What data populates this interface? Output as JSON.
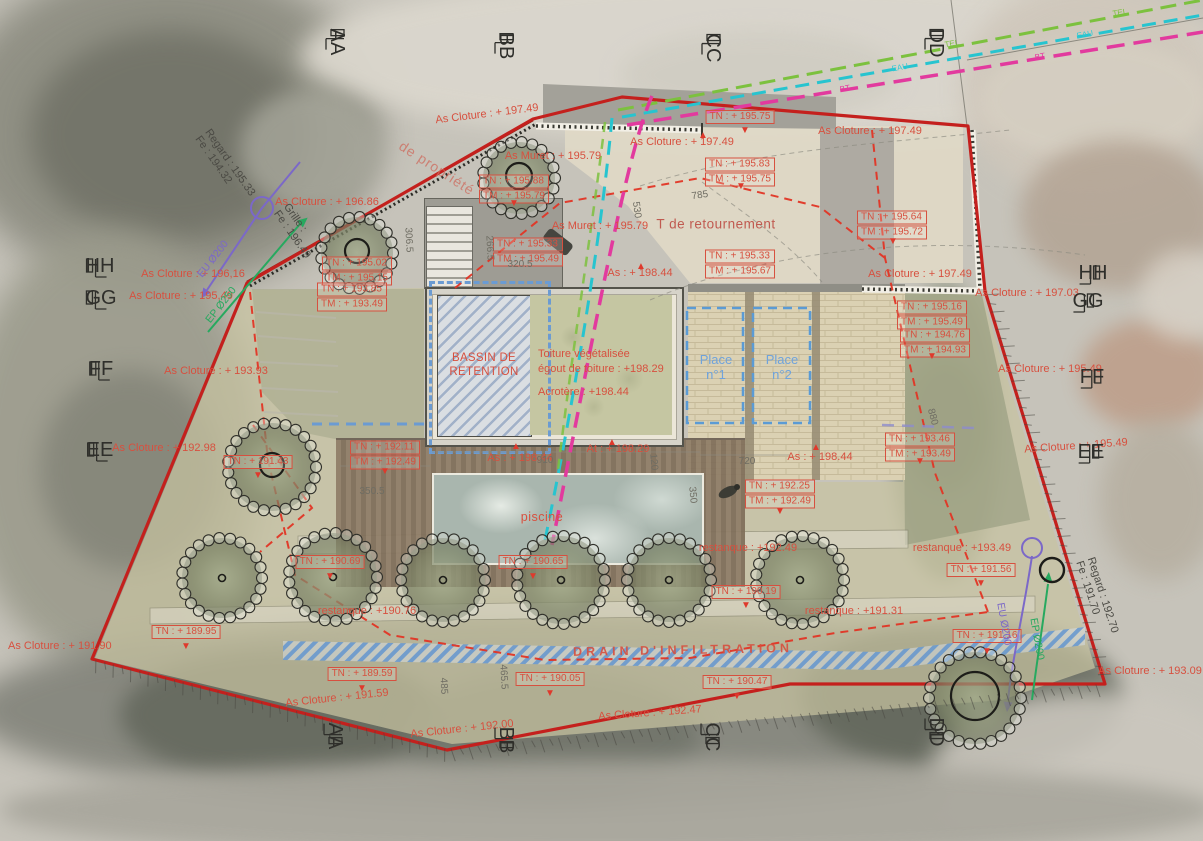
{
  "plan": {
    "type": "plan de masse / site plan on aerial photo",
    "colors": {
      "boundary_red": "#c4201d",
      "annotation_red": "#d7503f",
      "parking_blue": "#6fa3dc",
      "drain_blue": "#6b9bd2",
      "eu_purple": "#7b68c8",
      "ep_green": "#27a95f",
      "tel_green": "#7cc13e",
      "eau_cyan": "#27c4cf",
      "bt_magenta": "#e23a9e"
    }
  },
  "labels": {
    "piscine": "piscine",
    "drain": "DRAIN D'INFILTRATION",
    "t_retournement": "T de retournement",
    "acrotere": "Acrotère : +198.44"
  },
  "markers": [
    {
      "label": "AA",
      "x": 337,
      "y": 42,
      "side": "top"
    },
    {
      "label": "BB",
      "x": 506,
      "y": 46,
      "side": "top"
    },
    {
      "label": "CC",
      "x": 713,
      "y": 48,
      "side": "top"
    },
    {
      "label": "DD",
      "x": 936,
      "y": 43,
      "side": "top"
    },
    {
      "label": "HH",
      "x": 100,
      "y": 266,
      "side": "left"
    },
    {
      "label": "GG",
      "x": 101,
      "y": 298,
      "side": "left"
    },
    {
      "label": "FF",
      "x": 101,
      "y": 369,
      "side": "left"
    },
    {
      "label": "EE",
      "x": 100,
      "y": 450,
      "side": "left"
    },
    {
      "label": "HH",
      "x": 1093,
      "y": 273,
      "side": "right"
    },
    {
      "label": "GG",
      "x": 1088,
      "y": 301,
      "side": "right"
    },
    {
      "label": "FF",
      "x": 1092,
      "y": 377,
      "side": "right"
    },
    {
      "label": "EE",
      "x": 1091,
      "y": 452,
      "side": "right"
    },
    {
      "label": "AA",
      "x": 335,
      "y": 736,
      "side": "bottom"
    },
    {
      "label": "BB",
      "x": 506,
      "y": 740,
      "side": "bottom"
    },
    {
      "label": "CC",
      "x": 712,
      "y": 737,
      "side": "bottom"
    },
    {
      "label": "DD",
      "x": 936,
      "y": 732,
      "side": "bottom"
    }
  ],
  "annotations": [
    {
      "t": "As Cloture : + 197.49",
      "x": 487,
      "y": 114,
      "r": -7
    },
    {
      "t": "As Cloture : + 197.49",
      "x": 682,
      "y": 142
    },
    {
      "t": "As Cloture : + 197.49",
      "x": 870,
      "y": 131
    },
    {
      "t": "As Cloture : + 197.49",
      "x": 920,
      "y": 274
    },
    {
      "t": "As Cloture : + 197.03",
      "x": 1027,
      "y": 293
    },
    {
      "t": "As Cloture : + 196.86",
      "x": 327,
      "y": 202
    },
    {
      "t": "As Cloture : + 196,16",
      "x": 193,
      "y": 274
    },
    {
      "t": "As Cloture : + 195,49",
      "x": 181,
      "y": 296
    },
    {
      "t": "As Cloture : + 193.93",
      "x": 216,
      "y": 371
    },
    {
      "t": "As Cloture : + 192.98",
      "x": 164,
      "y": 448
    },
    {
      "t": "As Cloture : + 195.49",
      "x": 1050,
      "y": 369
    },
    {
      "t": "As Cloture : + 195.49",
      "x": 1076,
      "y": 446,
      "r": -4
    },
    {
      "t": "As Cloture : + 191.90",
      "x": 8,
      "y": 646,
      "a": "l"
    },
    {
      "t": "As Cloture : + 191.59",
      "x": 337,
      "y": 698,
      "r": -6
    },
    {
      "t": "As Cloture : + 192.00",
      "x": 462,
      "y": 729,
      "r": -6
    },
    {
      "t": "As Cloture : + 192.47",
      "x": 650,
      "y": 713,
      "r": -4
    },
    {
      "t": "As Cloture : + 193.09",
      "x": 1150,
      "y": 671
    },
    {
      "t": "As Muret : + 195.79",
      "x": 553,
      "y": 156
    },
    {
      "t": "As Muret : + 195.79",
      "x": 600,
      "y": 226
    },
    {
      "t": "As : + 198.44",
      "x": 640,
      "y": 273
    },
    {
      "t": "As : + 198.44",
      "x": 520,
      "y": 458
    },
    {
      "t": "As : + 198.44",
      "x": 820,
      "y": 457
    },
    {
      "t": "At : + 198.29",
      "x": 618,
      "y": 449
    },
    {
      "t": "restanque : +192.49",
      "x": 748,
      "y": 548
    },
    {
      "t": "restanque : +193.49",
      "x": 962,
      "y": 548
    },
    {
      "t": "restanque : +191.31",
      "x": 854,
      "y": 611
    },
    {
      "t": "restanque : +190.76",
      "x": 367,
      "y": 611
    },
    {
      "lines": [
        "TN : + 195.75"
      ],
      "x": 740,
      "y": 117,
      "k": "box"
    },
    {
      "lines": [
        "TN : + 195.83",
        "TM : + 195.75"
      ],
      "x": 740,
      "y": 172,
      "k": "box"
    },
    {
      "lines": [
        "TN : + 195.64",
        "TM : + 195.72"
      ],
      "x": 892,
      "y": 225,
      "k": "box"
    },
    {
      "lines": [
        "TN : + 195.88",
        "TM : + 195.79"
      ],
      "x": 514,
      "y": 189,
      "k": "box"
    },
    {
      "lines": [
        "TN : + 195.33",
        "TM : + 195.49"
      ],
      "x": 528,
      "y": 252,
      "k": "box"
    },
    {
      "lines": [
        "TN : + 195.33",
        "TM : + 195.67"
      ],
      "x": 740,
      "y": 264,
      "k": "box"
    },
    {
      "lines": [
        "TN : + 195.02",
        "TM : + 195.15"
      ],
      "x": 357,
      "y": 271,
      "k": "box"
    },
    {
      "lines": [
        "TN : + 193.85",
        "TM : + 193.49"
      ],
      "x": 352,
      "y": 297,
      "k": "box"
    },
    {
      "lines": [
        "TN : + 192.11",
        "TM : + 192.49"
      ],
      "x": 385,
      "y": 455,
      "k": "box"
    },
    {
      "lines": [
        "TN : + 192.25",
        "TM : + 192.49"
      ],
      "x": 780,
      "y": 494,
      "k": "box"
    },
    {
      "lines": [
        "TN : + 195.16",
        "TM : + 195.49"
      ],
      "x": 932,
      "y": 315,
      "k": "box"
    },
    {
      "lines": [
        "TN : + 194.76",
        "TM : + 194.93"
      ],
      "x": 935,
      "y": 343,
      "k": "box"
    },
    {
      "lines": [
        "TN : + 193.46",
        "TM : + 193.49"
      ],
      "x": 920,
      "y": 447,
      "k": "box"
    },
    {
      "lines": [
        "TN : + 191.43"
      ],
      "x": 258,
      "y": 462,
      "k": "box"
    },
    {
      "lines": [
        "TN : + 191.56"
      ],
      "x": 981,
      "y": 570,
      "k": "box"
    },
    {
      "lines": [
        "TN : + 191.16"
      ],
      "x": 987,
      "y": 636,
      "k": "box"
    },
    {
      "lines": [
        "TN : + 190.19"
      ],
      "x": 746,
      "y": 592,
      "k": "box"
    },
    {
      "lines": [
        "TN : + 190.69"
      ],
      "x": 330,
      "y": 562,
      "k": "box"
    },
    {
      "lines": [
        "TN : + 190.65"
      ],
      "x": 533,
      "y": 562,
      "k": "box"
    },
    {
      "lines": [
        "TN : + 189.95"
      ],
      "x": 186,
      "y": 632,
      "k": "box"
    },
    {
      "lines": [
        "TN : + 189.59"
      ],
      "x": 362,
      "y": 674,
      "k": "box"
    },
    {
      "lines": [
        "TN : + 190.05"
      ],
      "x": 550,
      "y": 679,
      "k": "box"
    },
    {
      "lines": [
        "TN : + 190.47"
      ],
      "x": 737,
      "y": 682,
      "k": "box"
    },
    {
      "lines": [
        "BASSIN DE",
        "RETENTION"
      ],
      "x": 484,
      "y": 365,
      "k": "redc"
    },
    {
      "lines": [
        "Toiture végétalisée",
        "égout de toiture : +198.29"
      ],
      "x": 538,
      "y": 362,
      "k": "redl",
      "a": "l"
    },
    {
      "lines": [
        "Place",
        "n°1"
      ],
      "x": 716,
      "y": 367,
      "k": "blue"
    },
    {
      "lines": [
        "Place",
        "n°2"
      ],
      "x": 782,
      "y": 367,
      "k": "blue"
    },
    {
      "t": "785",
      "x": 700,
      "y": 196,
      "r": -8,
      "k": "dim"
    },
    {
      "t": "530",
      "x": 636,
      "y": 210,
      "r": 82,
      "k": "dim"
    },
    {
      "t": "306.5",
      "x": 408,
      "y": 240,
      "r": 87,
      "k": "dim"
    },
    {
      "t": "266.5",
      "x": 489,
      "y": 248,
      "r": 87,
      "k": "dim"
    },
    {
      "t": "320.5",
      "x": 520,
      "y": 265,
      "k": "dim"
    },
    {
      "t": "910",
      "x": 545,
      "y": 461,
      "k": "dim"
    },
    {
      "t": "350.5",
      "x": 372,
      "y": 492,
      "k": "dim"
    },
    {
      "t": "720",
      "x": 747,
      "y": 462,
      "k": "dim"
    },
    {
      "t": "120",
      "x": 653,
      "y": 462,
      "r": 85,
      "k": "dim"
    },
    {
      "t": "350",
      "x": 692,
      "y": 495,
      "r": 85,
      "k": "dim"
    },
    {
      "t": "880",
      "x": 932,
      "y": 417,
      "r": 75,
      "k": "dim"
    },
    {
      "t": "465.5",
      "x": 503,
      "y": 677,
      "r": 87,
      "k": "dim"
    },
    {
      "t": "485",
      "x": 443,
      "y": 686,
      "r": 87,
      "k": "dim"
    },
    {
      "lines": [
        "Regard : 195.33",
        "Fe : 194.32"
      ],
      "x": 225,
      "y": 166,
      "r": 55,
      "k": "dark"
    },
    {
      "lines": [
        "Grille :",
        "Fe : 196.49"
      ],
      "x": 297,
      "y": 231,
      "r": 55,
      "k": "dark"
    },
    {
      "lines": [
        "Regard : 192.70",
        "Fe : 191.70"
      ],
      "x": 1097,
      "y": 597,
      "r": 72,
      "k": "dark"
    },
    {
      "t": "EU Ø200",
      "x": 213,
      "y": 259,
      "r": -52,
      "k": "purple"
    },
    {
      "t": "EP Ø250",
      "x": 221,
      "y": 305,
      "r": -52,
      "k": "greenu"
    },
    {
      "t": "EU Ø200",
      "x": 1004,
      "y": 624,
      "r": 80,
      "k": "purple"
    },
    {
      "t": "EP Ø200",
      "x": 1037,
      "y": 639,
      "r": 80,
      "k": "greenu"
    },
    {
      "t": "TEL",
      "x": 952,
      "y": 44,
      "r": -10,
      "k": "tel"
    },
    {
      "t": "EAU",
      "x": 900,
      "y": 68,
      "r": -10,
      "k": "eau"
    },
    {
      "t": "BT",
      "x": 845,
      "y": 89,
      "r": -10,
      "k": "bt"
    },
    {
      "t": "TEL",
      "x": 1120,
      "y": 13,
      "r": -10,
      "k": "tel"
    },
    {
      "t": "EAU",
      "x": 1085,
      "y": 35,
      "r": -10,
      "k": "eau"
    },
    {
      "t": "BT",
      "x": 1040,
      "y": 57,
      "r": -10,
      "k": "bt"
    },
    {
      "t": "de propriété",
      "x": 437,
      "y": 168,
      "r": 33,
      "k": "pink"
    },
    {
      "t": "▲",
      "x": 516,
      "y": 447,
      "k": "tri"
    },
    {
      "t": "▲",
      "x": 612,
      "y": 443,
      "k": "tri"
    },
    {
      "t": "▲",
      "x": 816,
      "y": 448,
      "k": "tri"
    },
    {
      "t": "▲",
      "x": 641,
      "y": 267,
      "k": "tri"
    },
    {
      "t": "▲",
      "x": 703,
      "y": 136,
      "k": "tri"
    },
    {
      "t": "▼",
      "x": 385,
      "y": 472,
      "k": "tri"
    },
    {
      "t": "▼",
      "x": 780,
      "y": 512,
      "k": "tri"
    },
    {
      "t": "▼",
      "x": 932,
      "y": 357,
      "k": "tri"
    },
    {
      "t": "▼",
      "x": 920,
      "y": 462,
      "k": "tri"
    },
    {
      "t": "▼",
      "x": 987,
      "y": 652,
      "k": "tri"
    },
    {
      "t": "▼",
      "x": 550,
      "y": 694,
      "k": "tri"
    },
    {
      "t": "▼",
      "x": 737,
      "y": 697,
      "k": "tri"
    },
    {
      "t": "▼",
      "x": 186,
      "y": 647,
      "k": "tri"
    },
    {
      "t": "▼",
      "x": 362,
      "y": 689,
      "k": "tri"
    },
    {
      "t": "▼",
      "x": 746,
      "y": 606,
      "k": "tri"
    },
    {
      "t": "▼",
      "x": 330,
      "y": 577,
      "k": "tri"
    },
    {
      "t": "▼",
      "x": 533,
      "y": 577,
      "k": "tri"
    },
    {
      "t": "▼",
      "x": 745,
      "y": 131,
      "k": "tri"
    },
    {
      "t": "▼",
      "x": 893,
      "y": 242,
      "k": "tri"
    },
    {
      "t": "▼",
      "x": 741,
      "y": 187,
      "k": "tri"
    },
    {
      "t": "▼",
      "x": 514,
      "y": 204,
      "k": "tri"
    },
    {
      "t": "▼",
      "x": 258,
      "y": 476,
      "k": "tri"
    },
    {
      "t": "▼",
      "x": 981,
      "y": 584,
      "k": "tri"
    }
  ]
}
